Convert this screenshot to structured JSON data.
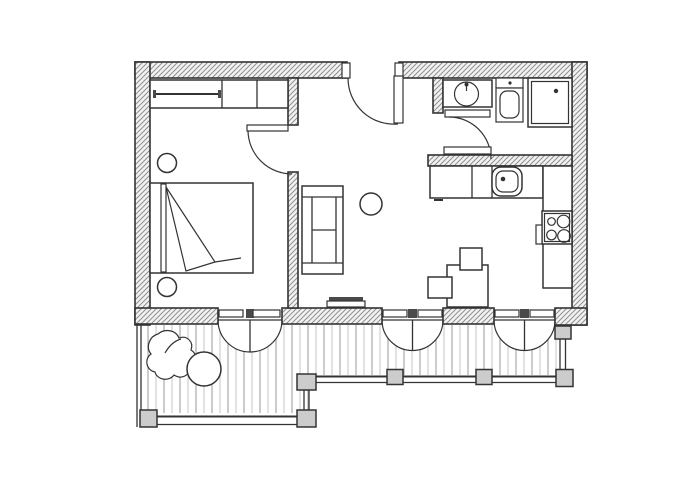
{
  "document": {
    "type": "architectural floor plan, scanned black-line drawing, no text labels",
    "view": "top-down plan of a studio apartment with wraparound deck"
  },
  "colors": {
    "paper": "#ffffff",
    "line": "#333333",
    "hatch": "#8f8f8f",
    "wall_fill": "#f2f2f2",
    "plank": "#a5a5a5",
    "post_fill": "#cccccc",
    "dark_fill": "#4a4a4a"
  },
  "rooms": {
    "bedroom": {
      "label": "Bedroom",
      "items": [
        "wardrobe with hanging rail and shelves",
        "double bed with headboard and folded blanket",
        "round stool upper",
        "round stool lower"
      ]
    },
    "living_room": {
      "label": "Living room",
      "items": [
        "sofa with two armrests",
        "round coffee table",
        "radiator / mat strip at south wall"
      ]
    },
    "kitchen": {
      "label": "Kitchen",
      "items": [
        "north counter with cabinets",
        "double-frame sink with faucet dot",
        "right-wall counter",
        "cooktop with four burners",
        "oven handle",
        "square dining table",
        "chair above table",
        "chair left of table"
      ]
    },
    "bathroom": {
      "label": "Bathroom",
      "items": [
        "washing machine (round drum, dial dot)",
        "toilet with cistern",
        "shower square with drain dot",
        "shelf strip above south wall"
      ]
    },
    "entry": {
      "label": "Entry nook"
    },
    "deck": {
      "label": "Deck",
      "items": [
        "vertical wood planks",
        "leafy potted plant",
        "round patio table",
        "railing with posts on three sides"
      ]
    }
  },
  "doors": {
    "entrance": "single door in top wall, leaf hanging inward, quarter-circle swing",
    "bedroom_door": "single door in bedroom partition, swings into bedroom",
    "bathroom_door": "single door at bathroom west opening, quarter-circle swing",
    "french_bedroom": "double door to deck, semicircular outward swing",
    "french_living": "double door to deck, semicircular outward swing",
    "french_kitchen": "double door to deck, semicircular outward swing"
  },
  "walls": {
    "style": "diagonal-hatched fill",
    "exterior_thickness_px": 16,
    "interior_thickness_px": 10
  }
}
